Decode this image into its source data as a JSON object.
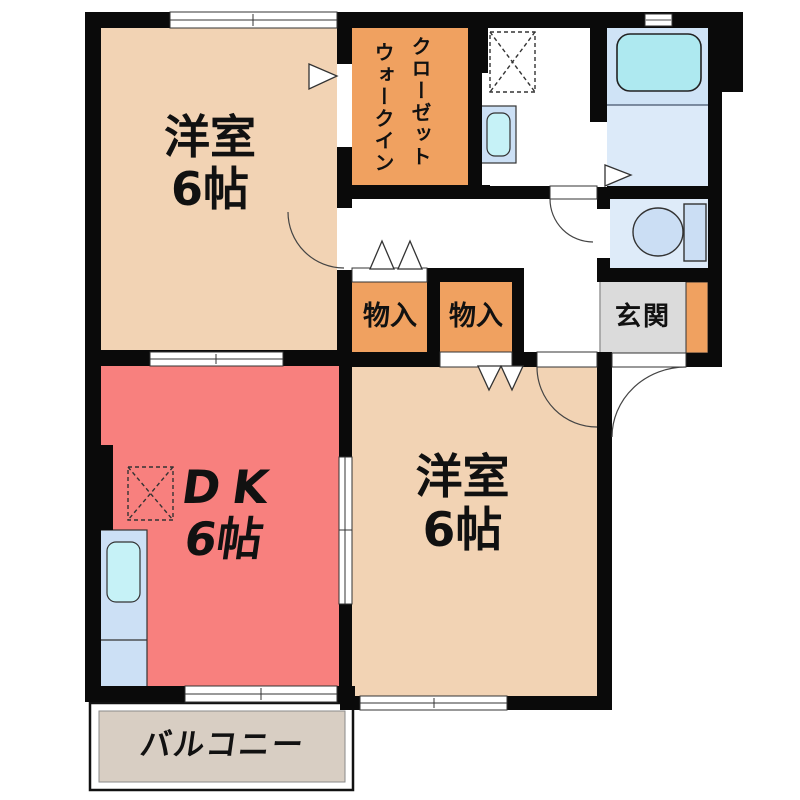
{
  "rooms": {
    "bedroom_nw": {
      "name": "洋室",
      "size": "6帖"
    },
    "walkin_closet": {
      "line1": "クローゼット",
      "line2": "ウォークイン"
    },
    "storage_left": {
      "name": "物入"
    },
    "storage_right": {
      "name": "物入"
    },
    "genkan": {
      "name": "玄関"
    },
    "dk": {
      "name": "DK",
      "size": "6帖"
    },
    "bedroom_se": {
      "name": "洋室",
      "size": "6帖"
    },
    "balcony": {
      "name": "バルコニー"
    }
  },
  "colors": {
    "wall": "#0a0a0a",
    "bedroom": "#F2D3B4",
    "dk": "#F8807E",
    "storage": "#F0A160",
    "balcony": "#D8CEC3",
    "genkan_floor": "#DBDBDB",
    "bath_upper": "#CFE3F6",
    "bath_lower": "#DCEAF9",
    "toilet_room": "#DEEBF9",
    "fixture_blue": "#CBDEF4",
    "counter": "#CCE0F5",
    "basin": "#C6F2F7",
    "tub": "#AEE9F0"
  }
}
